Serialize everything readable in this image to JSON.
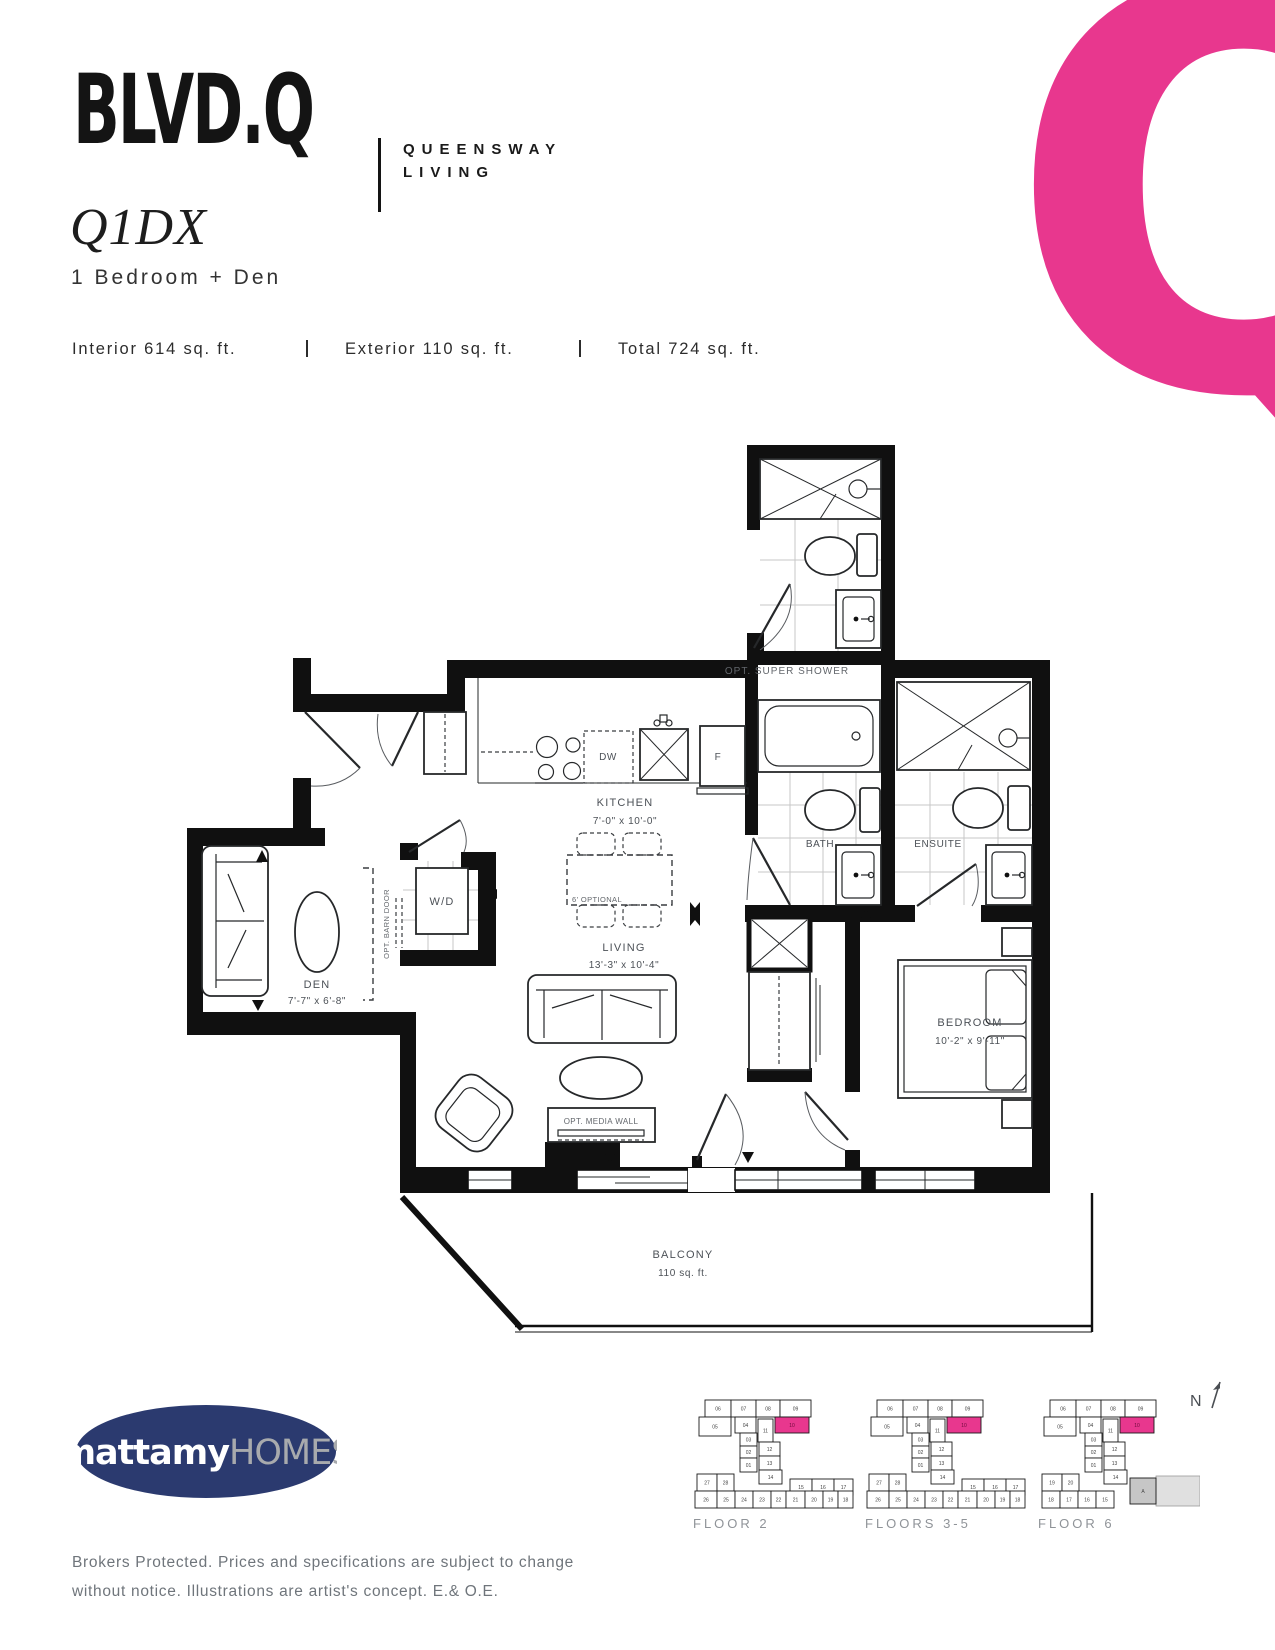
{
  "header": {
    "logo": "BLVD.Q",
    "tagline_line1": "QUEENSWAY",
    "tagline_line2": "LIVING",
    "big_letter": "Q"
  },
  "unit": {
    "model": "Q1DX",
    "type": "1 Bedroom + Den",
    "interior": "Interior 614 sq. ft.",
    "exterior": "Exterior 110 sq. ft.",
    "total": "Total 724 sq. ft."
  },
  "floorplan": {
    "inset_label": "OPT. SUPER SHOWER",
    "kitchen": {
      "name": "KITCHEN",
      "dims": "7'-0\" x 10'-0\""
    },
    "living": {
      "name": "LIVING",
      "dims": "13'-3\" x 10'-4\""
    },
    "den": {
      "name": "DEN",
      "dims": "7'-7\" x 6'-8\""
    },
    "bedroom": {
      "name": "BEDROOM",
      "dims": "10'-2\" x 9'-11\""
    },
    "bath": "BATH",
    "ensuite": "ENSUITE",
    "wd": "W/D",
    "dw": "DW",
    "fridge": "F",
    "barn_door": "OPT. BARN DOOR",
    "media_wall": "OPT. MEDIA WALL",
    "table_optional": "6' OPTIONAL",
    "balcony": {
      "name": "BALCONY",
      "area": "110 sq. ft."
    }
  },
  "keyplans": {
    "north": "N",
    "plans": [
      {
        "label": "FLOOR 2",
        "highlight": "10",
        "units": [
          "06",
          "07",
          "08",
          "09",
          "05",
          "04",
          "11",
          "10",
          "03",
          "02",
          "01",
          "12",
          "13",
          "14",
          "27",
          "28",
          "15",
          "16",
          "17",
          "26",
          "25",
          "24",
          "23",
          "22",
          "21",
          "20",
          "19",
          "18"
        ]
      },
      {
        "label": "FLOORS 3-5",
        "highlight": "10",
        "units": [
          "06",
          "07",
          "08",
          "09",
          "05",
          "04",
          "11",
          "10",
          "03",
          "02",
          "01",
          "12",
          "13",
          "14",
          "27",
          "28",
          "15",
          "16",
          "17",
          "26",
          "25",
          "24",
          "23",
          "22",
          "21",
          "20",
          "19",
          "18"
        ]
      },
      {
        "label": "FLOOR 6",
        "highlight": "10",
        "units": [
          "06",
          "07",
          "08",
          "09",
          "05",
          "04",
          "11",
          "10",
          "03",
          "02",
          "01",
          "12",
          "13",
          "14",
          "19",
          "20",
          "A",
          "18",
          "17",
          "16",
          "15"
        ]
      }
    ]
  },
  "footer": {
    "builder_name": "mattamy",
    "builder_suffix": "HOMES",
    "disclaimer_1": "Brokers Protected. Prices and specifications are subject to change",
    "disclaimer_2": "without notice. Illustrations are artist's concept. E.& O.E."
  },
  "colors": {
    "accent_pink": "#E8378E",
    "navy": "#2B3A6F",
    "silver": "#A8AAAD"
  }
}
